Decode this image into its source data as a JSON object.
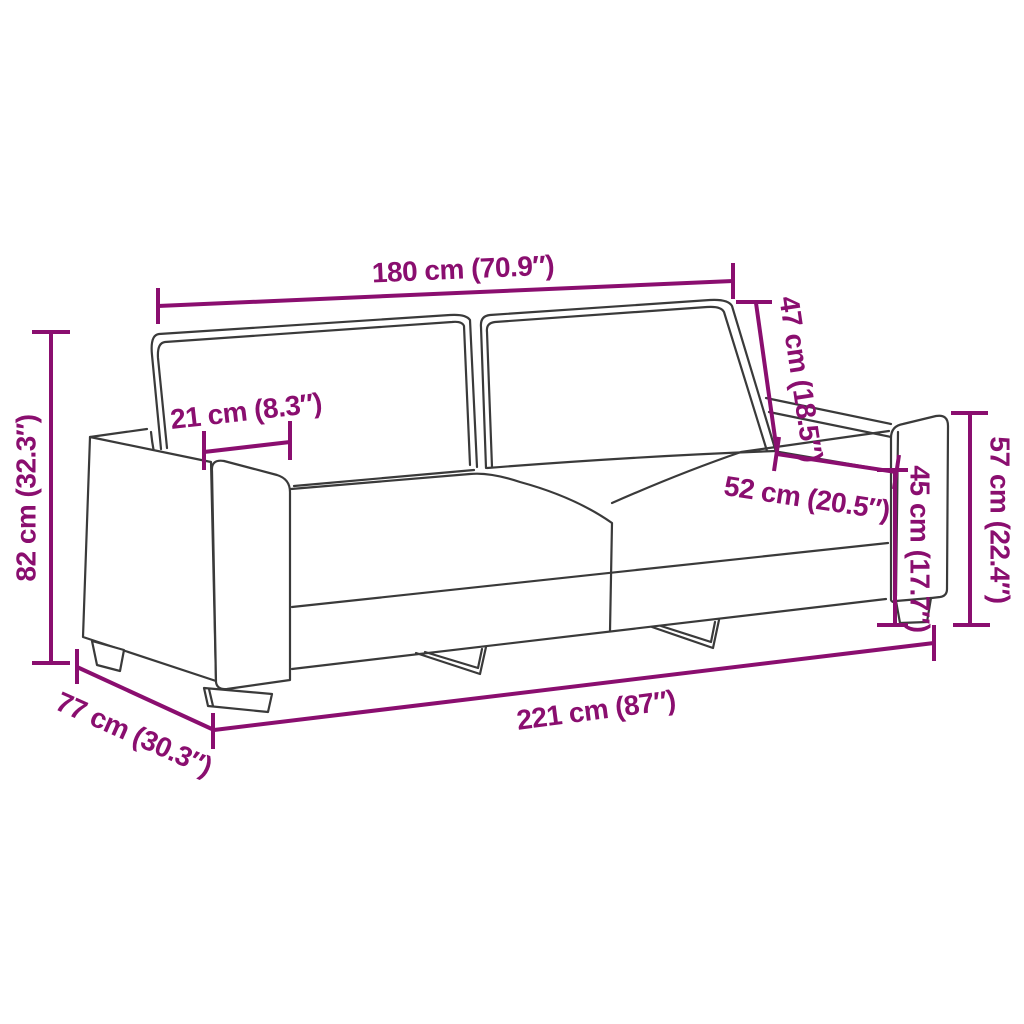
{
  "diagram": {
    "subject": "3-seater sofa dimension drawing",
    "colors": {
      "background": "#FFFFFF",
      "dimension_accent": "#8A0E6F",
      "sofa_outline": "#3A3A3A"
    },
    "dimensions": {
      "back_width": "180 cm (70.9″)",
      "armrest_width": "21 cm (8.3″)",
      "backrest_height": "47 cm (18.5″)",
      "seat_depth": "52 cm (20.5″)",
      "seat_height": "45 cm (17.7″)",
      "armrest_height": "57 cm (22.4″)",
      "total_height": "82 cm (32.3″)",
      "total_depth": "77 cm (30.3″)",
      "total_width": "221 cm (87″)"
    }
  }
}
